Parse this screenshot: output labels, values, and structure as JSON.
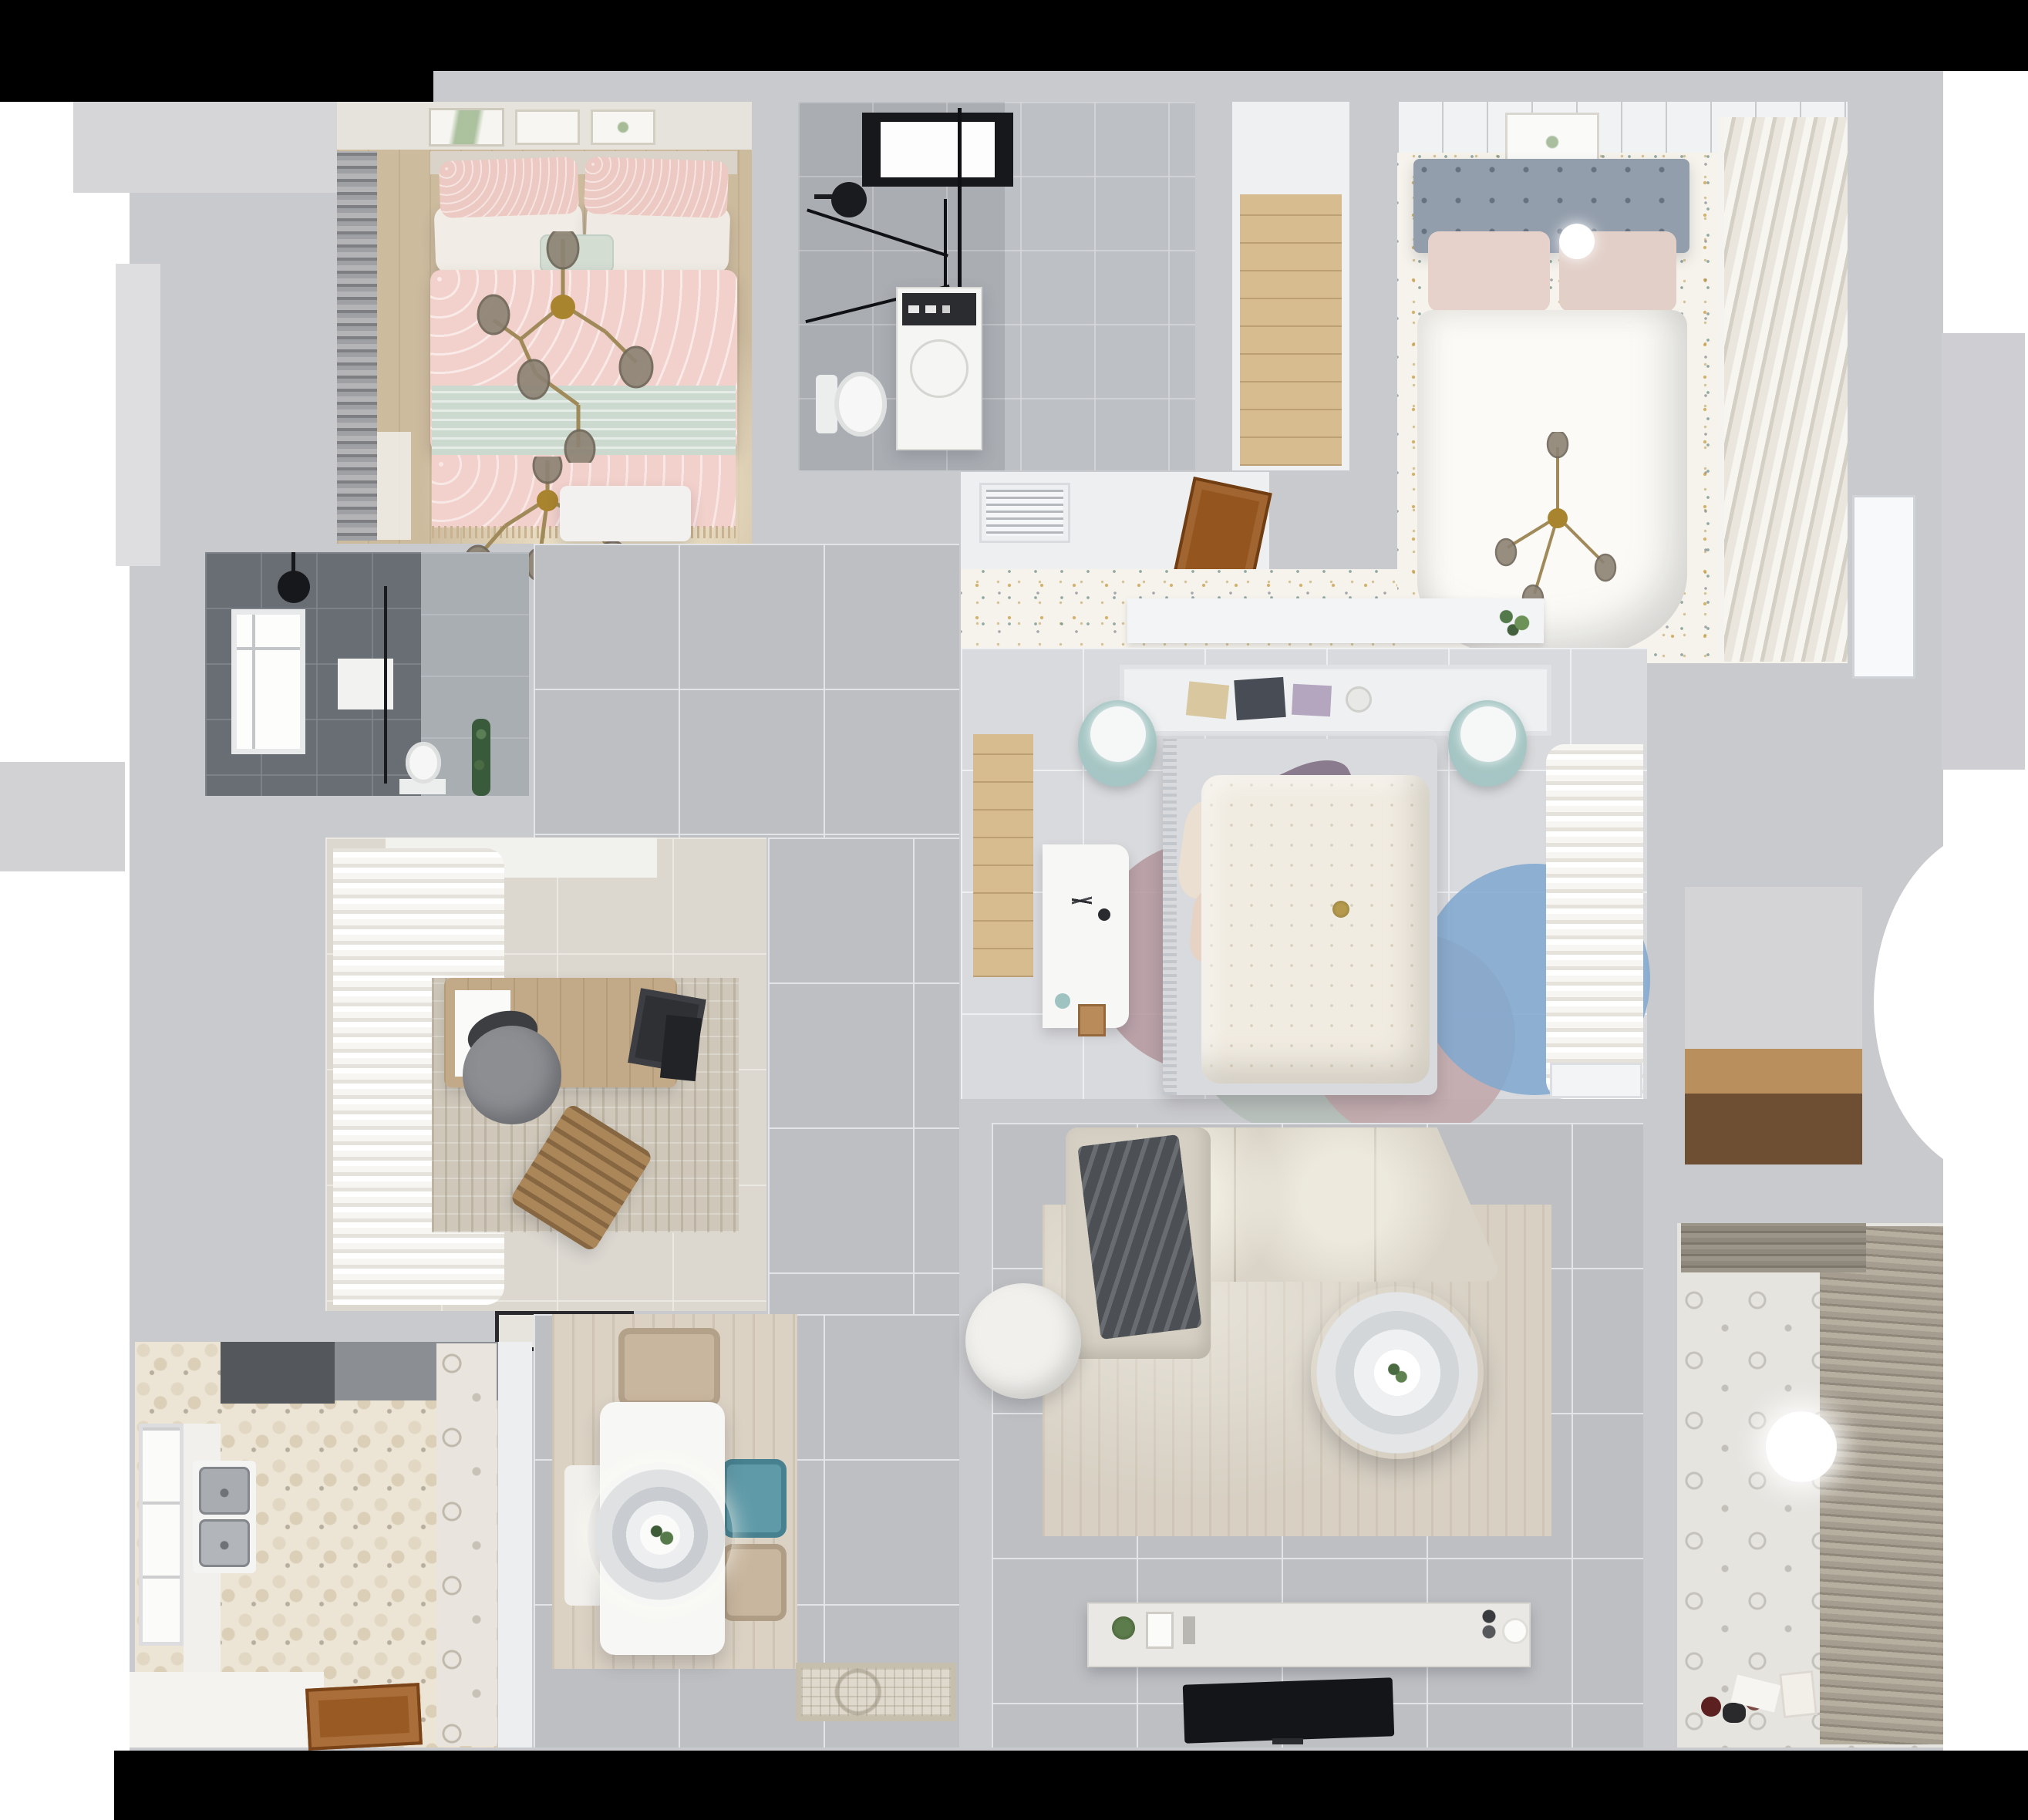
{
  "scene": {
    "title": "Apartment 3D Floor Plan",
    "description": "Photorealistic top-down 3D render of a furnished apartment floor plan with two bathrooms, three bedrooms, study, kitchen, dining area, living room and balcony",
    "view": "top-down",
    "background_color": "#ffffff",
    "frame_color": "#000000",
    "wall_color": "#c9cacd"
  },
  "palette": {
    "walls": "#c9cacd",
    "corridor_tile": "#bdbfc3",
    "bedroom3_tile": "#d9dadd",
    "terrazzo_floor": "#f6f3ec",
    "kitchen_hex_tile": "#ece4d4",
    "wood_floor": "#d7bc90",
    "pink_bedding": "#f2d0cb",
    "mint_throw": "#ccd9cf",
    "teal_chair": "#5f9aa8",
    "teal_nightstand": "#a5c6c4",
    "sofa_beige": "#dad4c8",
    "dark_throw": "#4c5055",
    "wood_door": "#95551f",
    "tv_black": "#141518",
    "dark_bath_tile": "#696e74",
    "brass_chandelier": "#a08a5a",
    "blue_rug": "#7fa8d0",
    "mauve_rug": "#b3969e"
  },
  "rooms": [
    {
      "id": "bedroom-pink",
      "name": "Bedroom (top-left)",
      "furniture": [
        "double bed with pink trellis duvet",
        "sage ruffled throw",
        "blush and white pillows",
        "mint accent cushion",
        "two brass branch chandeliers with smoked glass bulbs",
        "dark roman-shade curtain and window",
        "gallery wall with three botanical prints",
        "white side table"
      ]
    },
    {
      "id": "bathroom-main",
      "name": "Bathroom (top-center)",
      "furniture": [
        "black-framed skylight",
        "black glass shower enclosure",
        "black rain shower head",
        "washing machine with dark control panel",
        "toilet",
        "gray marble tile floor"
      ]
    },
    {
      "id": "closet-hall",
      "name": "Closet hallway (top-center-right)",
      "furniture": [
        "light oak plank floor",
        "white walls"
      ]
    },
    {
      "id": "bedroom-guest",
      "name": "Bedroom (top-right)",
      "furniture": [
        "bed with slate-blue tufted headboard",
        "blush pillows",
        "white duvet",
        "glowing sphere lamp",
        "brass cross chandelier",
        "framed botanical print",
        "louvered wardrobe doors",
        "confetti-speckle floor"
      ]
    },
    {
      "id": "vent-alcove",
      "name": "Utility alcove",
      "furniture": [
        "white louvered vent grille",
        "open wooden door",
        "terrazzo speckle floor",
        "white ledge with potted plant"
      ]
    },
    {
      "id": "bathroom-dark",
      "name": "Bathroom (middle-left)",
      "furniture": [
        "dark gray tile",
        "white framed window",
        "black shower head",
        "glass partition",
        "white shelf",
        "toilet",
        "tall green plant"
      ]
    },
    {
      "id": "study",
      "name": "Study",
      "furniture": [
        "white sheer curtains",
        "wood writing desk",
        "white paper",
        "dark laptop",
        "monitor",
        "gray swivel chair",
        "wooden slat lounge chair",
        "textured area rug",
        "black-bordered doormat"
      ]
    },
    {
      "id": "bedroom-master",
      "name": "Bedroom (center)",
      "furniture": [
        "bed with cream floral duvet",
        "purple and cream pillows",
        "white canopy shelf with books and bowl",
        "two teal round nightstands with white sphere lamps",
        "white corner desk with accessories",
        "overlapping round rugs in mauve, sage, rose and blue",
        "white sheer curtains",
        "low white cabinet",
        "oak floor niche"
      ]
    },
    {
      "id": "kitchen",
      "name": "Kitchen",
      "furniture": [
        "hexagon patterned tile",
        "dark range hood",
        "double stainless sink",
        "white counters",
        "bright window",
        "wooden door"
      ]
    },
    {
      "id": "dining",
      "name": "Dining area",
      "furniture": [
        "white rectangular table",
        "layered round pendant lamp with plant centerpiece",
        "beige chairs",
        "teal chair",
        "white bench chair",
        "wood-grain rug",
        "ornate entry doormat"
      ]
    },
    {
      "id": "living",
      "name": "Living room",
      "furniture": [
        "beige sectional sofa with chaise",
        "charcoal throw blanket",
        "round white pouf",
        "ringed round coffee table with plant",
        "large beige rug",
        "white TV console with plant, frames and candles",
        "wall-mounted black TV"
      ]
    },
    {
      "id": "balcony",
      "name": "Balcony / laundry",
      "furniture": [
        "venetian blinds",
        "patterned cement tile floor",
        "ceiling light",
        "scattered toys",
        "white bucket",
        "paper sheet"
      ]
    },
    {
      "id": "storage-niche",
      "name": "Storage niche (right)",
      "furniture": [
        "wooden shelf counter"
      ]
    }
  ]
}
